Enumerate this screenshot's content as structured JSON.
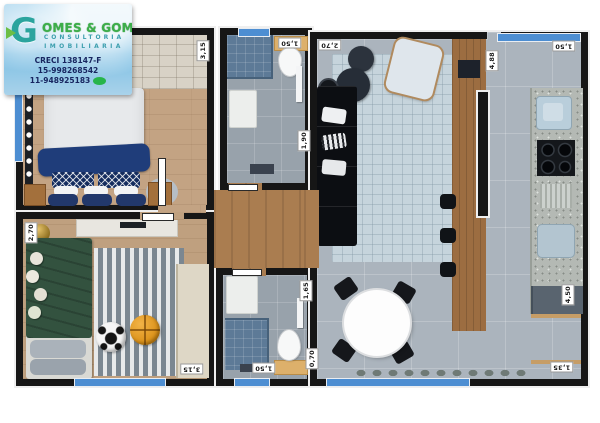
{
  "logo": {
    "g": "G",
    "brand": "OMES & GOMES",
    "line1": "CONSULTORIA",
    "line2": "IMOBILIARIA",
    "creci": "CRECI 138147-F",
    "phone1": "15-998268542",
    "phone2": "11-948925183"
  },
  "plan": {
    "wall_color": "#161616",
    "window_color": "#4d8ed2",
    "dims": [
      {
        "label": "3,15"
      },
      {
        "label": "1,50"
      },
      {
        "label": "1,90"
      },
      {
        "label": "2,70"
      },
      {
        "label": "4,88"
      },
      {
        "label": "1,50"
      },
      {
        "label": "2,70"
      },
      {
        "label": "3,15"
      },
      {
        "label": "1,65"
      },
      {
        "label": "1,50"
      },
      {
        "label": "0,70"
      },
      {
        "label": "4,50"
      },
      {
        "label": "1,35"
      }
    ]
  }
}
